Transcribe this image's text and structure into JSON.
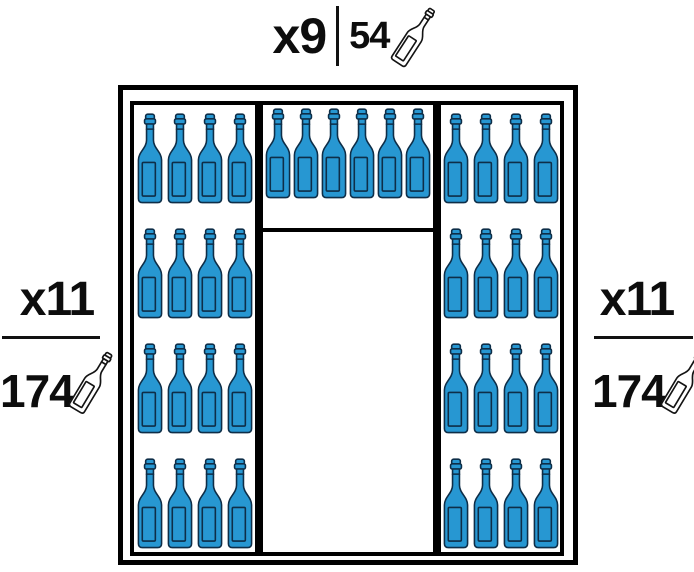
{
  "labels": {
    "top": {
      "multiplier": "x9",
      "count": "54",
      "icon": "wine-bottle-outline-icon"
    },
    "left": {
      "multiplier": "x11",
      "count": "174",
      "icon": "wine-bottle-outline-icon"
    },
    "right": {
      "multiplier": "x11",
      "count": "174",
      "icon": "wine-bottle-outline-icon"
    }
  },
  "cellar": {
    "columns": [
      {
        "id": "left",
        "rows": 4,
        "bottles_per_row": 4,
        "bottle_count": 16
      },
      {
        "id": "middle",
        "rows": 1,
        "bottles_per_row": 6,
        "bottle_count": 6
      },
      {
        "id": "right",
        "rows": 4,
        "bottles_per_row": 4,
        "bottle_count": 16
      }
    ]
  },
  "colors": {
    "bottle_fill": "#2797D2",
    "bottle_outline": "#0E2E48",
    "frame": "#000000",
    "text": "#0d0d0d",
    "background": "#ffffff"
  }
}
